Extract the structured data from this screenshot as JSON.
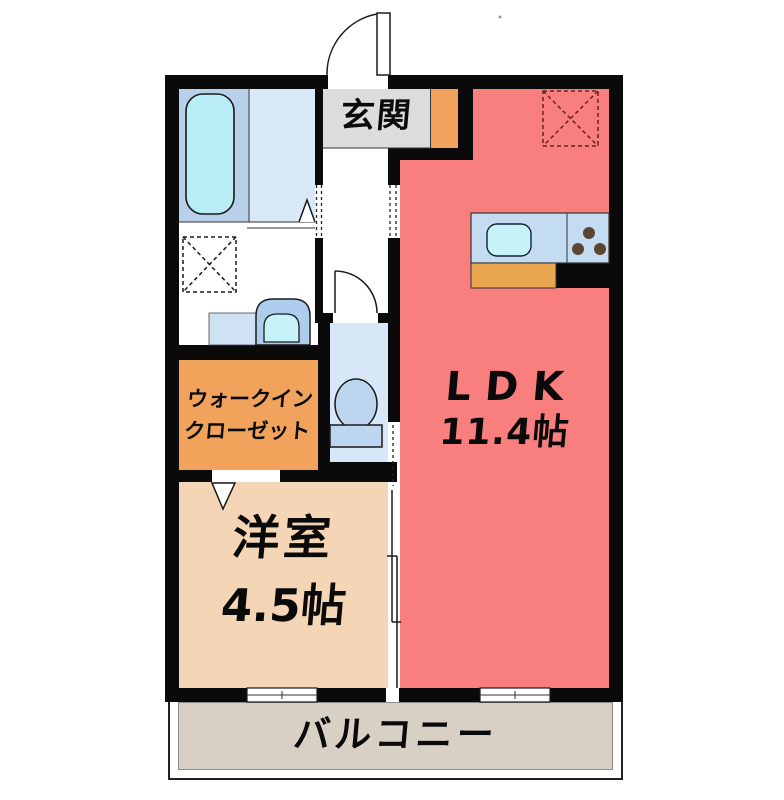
{
  "plan": {
    "rooms": {
      "genkan": {
        "label": "玄関"
      },
      "ldk": {
        "label": "LDK",
        "size": "11.4帖"
      },
      "youshitsu": {
        "label": "洋室",
        "size": "4.5帖"
      },
      "wic": {
        "label_line1": "ウォークイン",
        "label_line2": "クローゼット"
      },
      "balcony": {
        "label": "バルコニー"
      }
    },
    "fixtures": [
      "bathtub",
      "washing-machine-space",
      "washbasin",
      "toilet",
      "kitchen-sink",
      "stove-burners",
      "entrance-door",
      "toilet-door",
      "bathroom-folding-door",
      "closet-door",
      "sliding-door",
      "windows",
      "refrigerator-space"
    ],
    "colors": {
      "wall": "#0a0a0a",
      "ldk_red": "#f97f7f",
      "room_tan": "#f4d6b6",
      "closet_orange": "#f1a35c",
      "kitchen_orange": "#e8a64f",
      "genkan_gray": "#dcdcdc",
      "balcony_taupe": "#d8d0c5",
      "bath_light": "#d9e9f7",
      "bath_mid": "#b9d0ea",
      "tub_cyan": "#b8edf6",
      "toilet_blue": "#d7e7f7",
      "fixture_blue": "#bcd6f0",
      "counter_blue": "#c3dcf2",
      "sink_cyan": "#c8f2fa",
      "burner_brown": "#5a4632",
      "dash_red": "#6b2222"
    }
  }
}
